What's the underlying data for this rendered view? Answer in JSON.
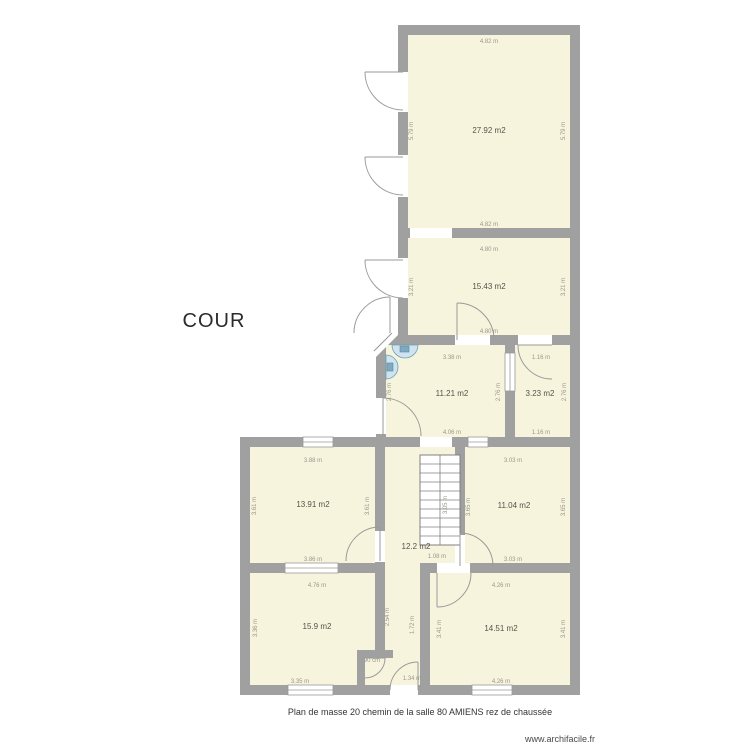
{
  "labels": {
    "cour": "COUR",
    "caption": "Plan de masse 20 chemin de la salle 80 AMIENS rez de chaussée",
    "footer": "www.archifacile.fr"
  },
  "colors": {
    "wall": "#a0a0a0",
    "room_fill": "#f7f4dd",
    "dim_text": "#9a978d",
    "area_text": "#55524a",
    "fixture_fill": "#cfe4ee",
    "fixture_stroke": "#6b9fb5",
    "door_arc": "#9a9a9a",
    "background": "#ffffff"
  },
  "rooms": [
    {
      "id": "salle-haut",
      "area": "27.92 m2"
    },
    {
      "id": "salle-milieu-haut",
      "area": "15.43 m2"
    },
    {
      "id": "entree",
      "area": "11.21 m2"
    },
    {
      "id": "wc",
      "area": "3.23 m2"
    },
    {
      "id": "salle-gauche",
      "area": "13.91 m2"
    },
    {
      "id": "hall-escalier",
      "area": "12.2 m2"
    },
    {
      "id": "salle-droite",
      "area": "11.04 m2"
    },
    {
      "id": "salle-bas-gauche",
      "area": "15.9 m2"
    },
    {
      "id": "salle-bas-droite",
      "area": "14.51 m2"
    }
  ],
  "dims": [
    {
      "text": "4.82 m"
    },
    {
      "text": "4.82 m"
    },
    {
      "text": "5.79 m"
    },
    {
      "text": "5.79 m"
    },
    {
      "text": "4.80 m"
    },
    {
      "text": "4.80 m"
    },
    {
      "text": "3.21 m"
    },
    {
      "text": "3.21 m"
    },
    {
      "text": "3.38 m"
    },
    {
      "text": "4.06 m"
    },
    {
      "text": "2.76 m"
    },
    {
      "text": "2.76 m"
    },
    {
      "text": "1.16 m"
    },
    {
      "text": "1.16 m"
    },
    {
      "text": "2.76 m"
    },
    {
      "text": "3.88 m"
    },
    {
      "text": "3.86 m"
    },
    {
      "text": "3.61 m"
    },
    {
      "text": "3.61 m"
    },
    {
      "text": "3.03 m"
    },
    {
      "text": "3.03 m"
    },
    {
      "text": "3.65 m"
    },
    {
      "text": "3.65 m"
    },
    {
      "text": "4.76 m"
    },
    {
      "text": "3.35 m"
    },
    {
      "text": "3.36 m"
    },
    {
      "text": "2.54 m"
    },
    {
      "text": "1.72 m"
    },
    {
      "text": "4.26 m"
    },
    {
      "text": "4.26 m"
    },
    {
      "text": "3.41 m"
    },
    {
      "text": "3.41 m"
    },
    {
      "text": "1.08 m"
    },
    {
      "text": "90 cm"
    },
    {
      "text": "1.34 m"
    },
    {
      "text": "3.05 m"
    }
  ]
}
